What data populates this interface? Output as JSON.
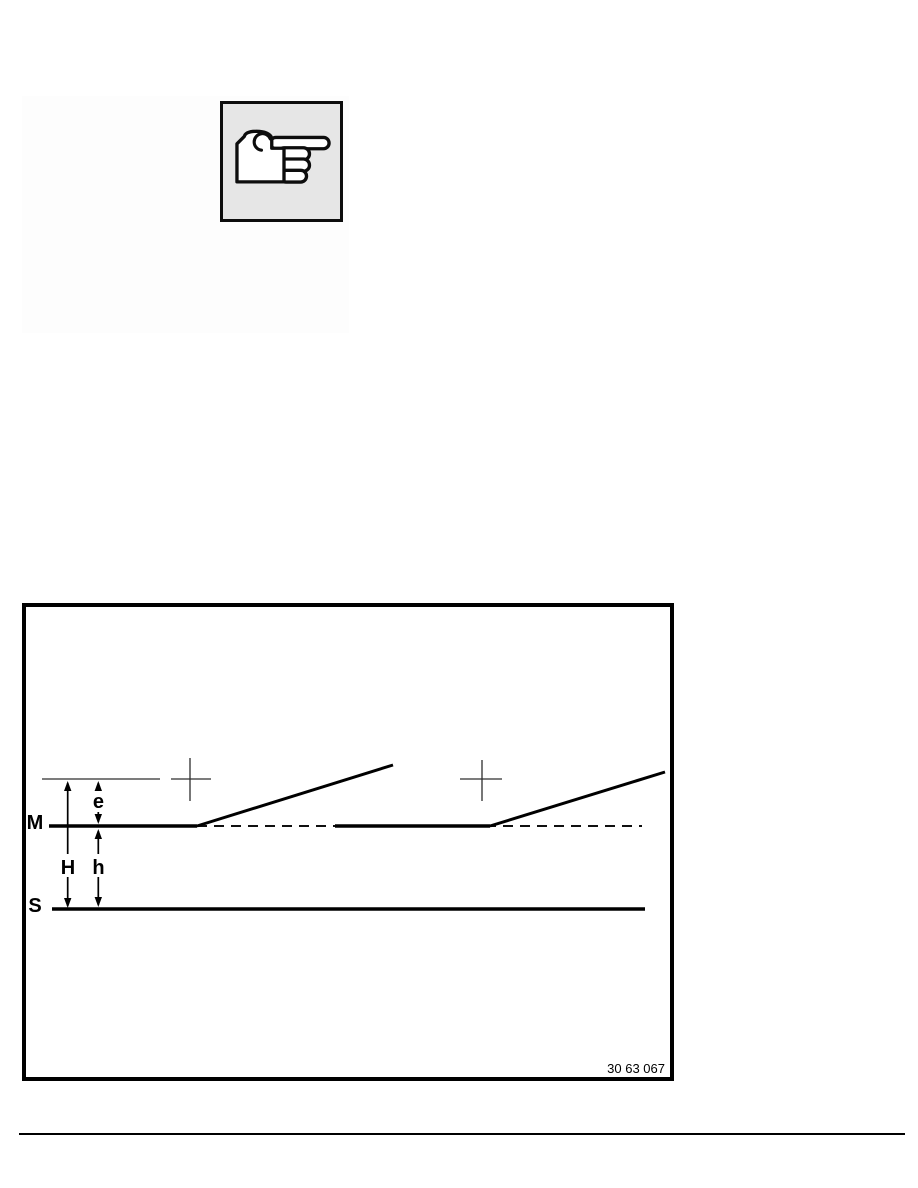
{
  "icons": {
    "note_icon": "pointing-hand-icon"
  },
  "note": {
    "box_fill": "#e6e6e6",
    "border_color": "#000000"
  },
  "figure": {
    "number": "30 63 067",
    "labels": {
      "m": "M",
      "s": "S",
      "H": "H",
      "h": "h",
      "e": "e"
    },
    "line_color": "#000000",
    "description": "Two horizontal reference levels M and S with dimension arrows e, H and h, two crosshair marks and two rising flank lines above a dashed M-level line"
  },
  "colors": {
    "ink": "#000000",
    "page_background": "#ffffff"
  }
}
